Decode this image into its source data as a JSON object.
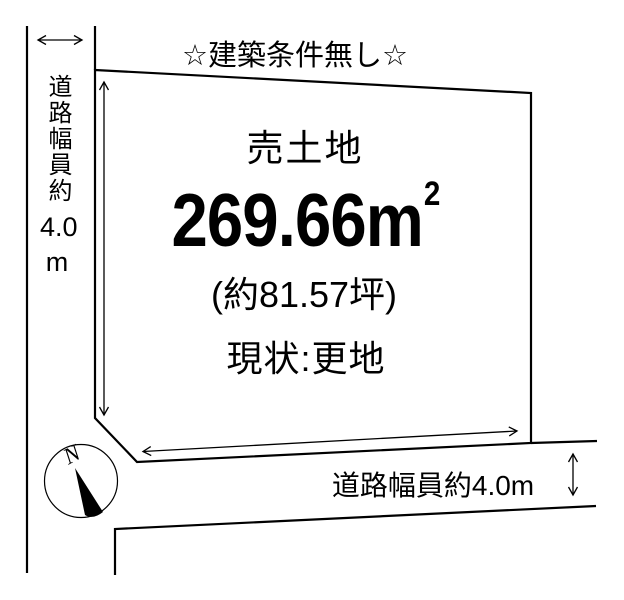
{
  "title": "☆建築条件無し☆",
  "plot": {
    "label": "売土地",
    "area_value": "269.66m",
    "area_sup": "2",
    "area_tsubo": "(約81.57坪)",
    "status": "現状:更地"
  },
  "left_road": {
    "label_vertical": "道路幅員約",
    "value": "4.0",
    "unit": "m"
  },
  "bottom_road": {
    "label": "道路幅員約4.0m"
  },
  "compass": {
    "label": "N"
  },
  "colors": {
    "line": "#000000",
    "background": "#ffffff"
  }
}
